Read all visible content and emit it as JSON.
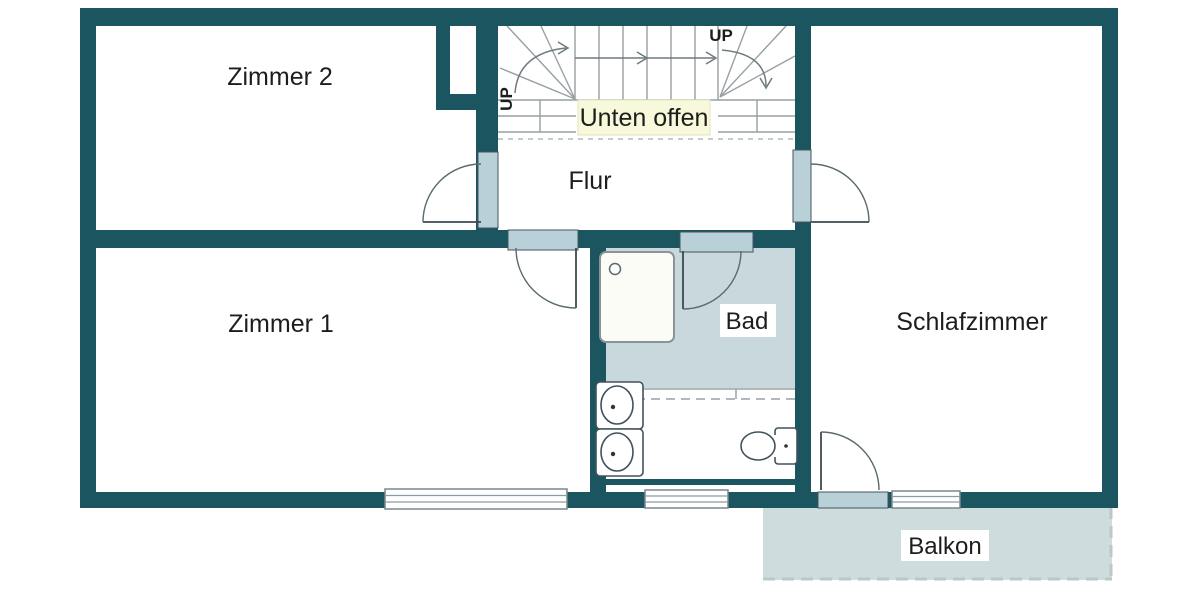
{
  "plan_title": "floor-plan",
  "rooms": {
    "zimmer2": {
      "label": "Zimmer 2"
    },
    "zimmer1": {
      "label": "Zimmer 1"
    },
    "flur": {
      "label": "Flur"
    },
    "bad": {
      "label": "Bad"
    },
    "schlafzimmer": {
      "label": "Schlafzimmer"
    },
    "balkon": {
      "label": "Balkon"
    }
  },
  "stairs": {
    "open_below_label": "Unten offen",
    "up_label_left": "UP",
    "up_label_right": "UP"
  },
  "colors": {
    "wall": "#1a5560",
    "door_window_frame": "#b9d0d9",
    "bathroom_floor": "#c9d8dd",
    "balcony_floor": "#cfdcdd",
    "open_below_background": "#f8f8da",
    "stair_lines": "#97a0a2"
  }
}
